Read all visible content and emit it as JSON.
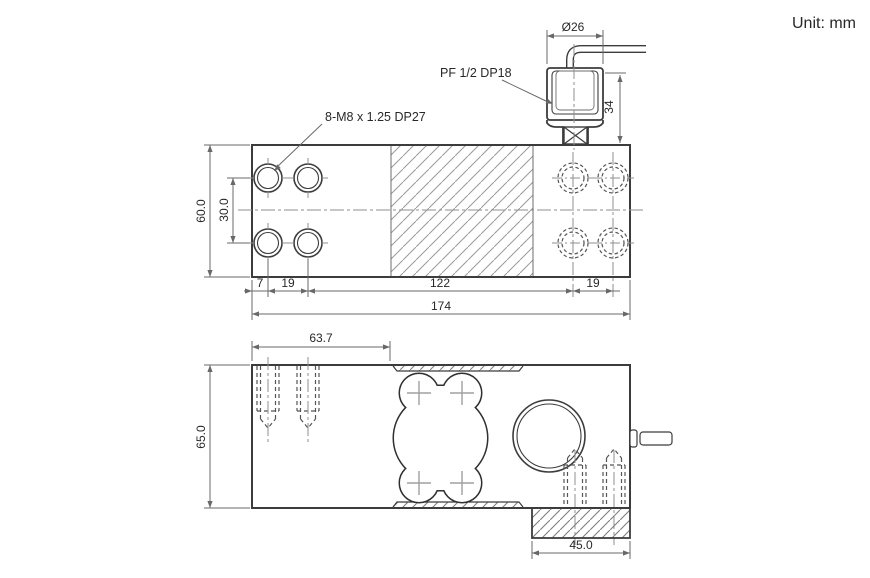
{
  "meta": {
    "unit_note": "Unit: mm",
    "drawing_type": "load cell dimensional drawing"
  },
  "colors": {
    "outline": "#3c3c3e",
    "dimension": "#686868",
    "centerline": "#8f8f8f",
    "hatch": "#9a9a9a",
    "text": "#28282a",
    "background": "#ffffff"
  },
  "top_view": {
    "name": "plan view",
    "labels": {
      "thread_spec": "8-M8 x 1.25 DP27",
      "connector_spec": "PF 1/2  DP18",
      "cable_gland_diameter": "Ø26",
      "connector_height": "34"
    },
    "dims": {
      "overall_length": "174",
      "edge_to_first_hole": "7",
      "hole_pitch_left": "19",
      "hole_span_center": "122",
      "hole_pitch_right": "19",
      "overall_width": "60.0",
      "hole_row_pitch": "30.0"
    }
  },
  "side_view": {
    "name": "side elevation",
    "dims": {
      "left_edge_to_pocket": "63.7",
      "overall_height": "65.0",
      "foot_length": "45.0"
    }
  }
}
